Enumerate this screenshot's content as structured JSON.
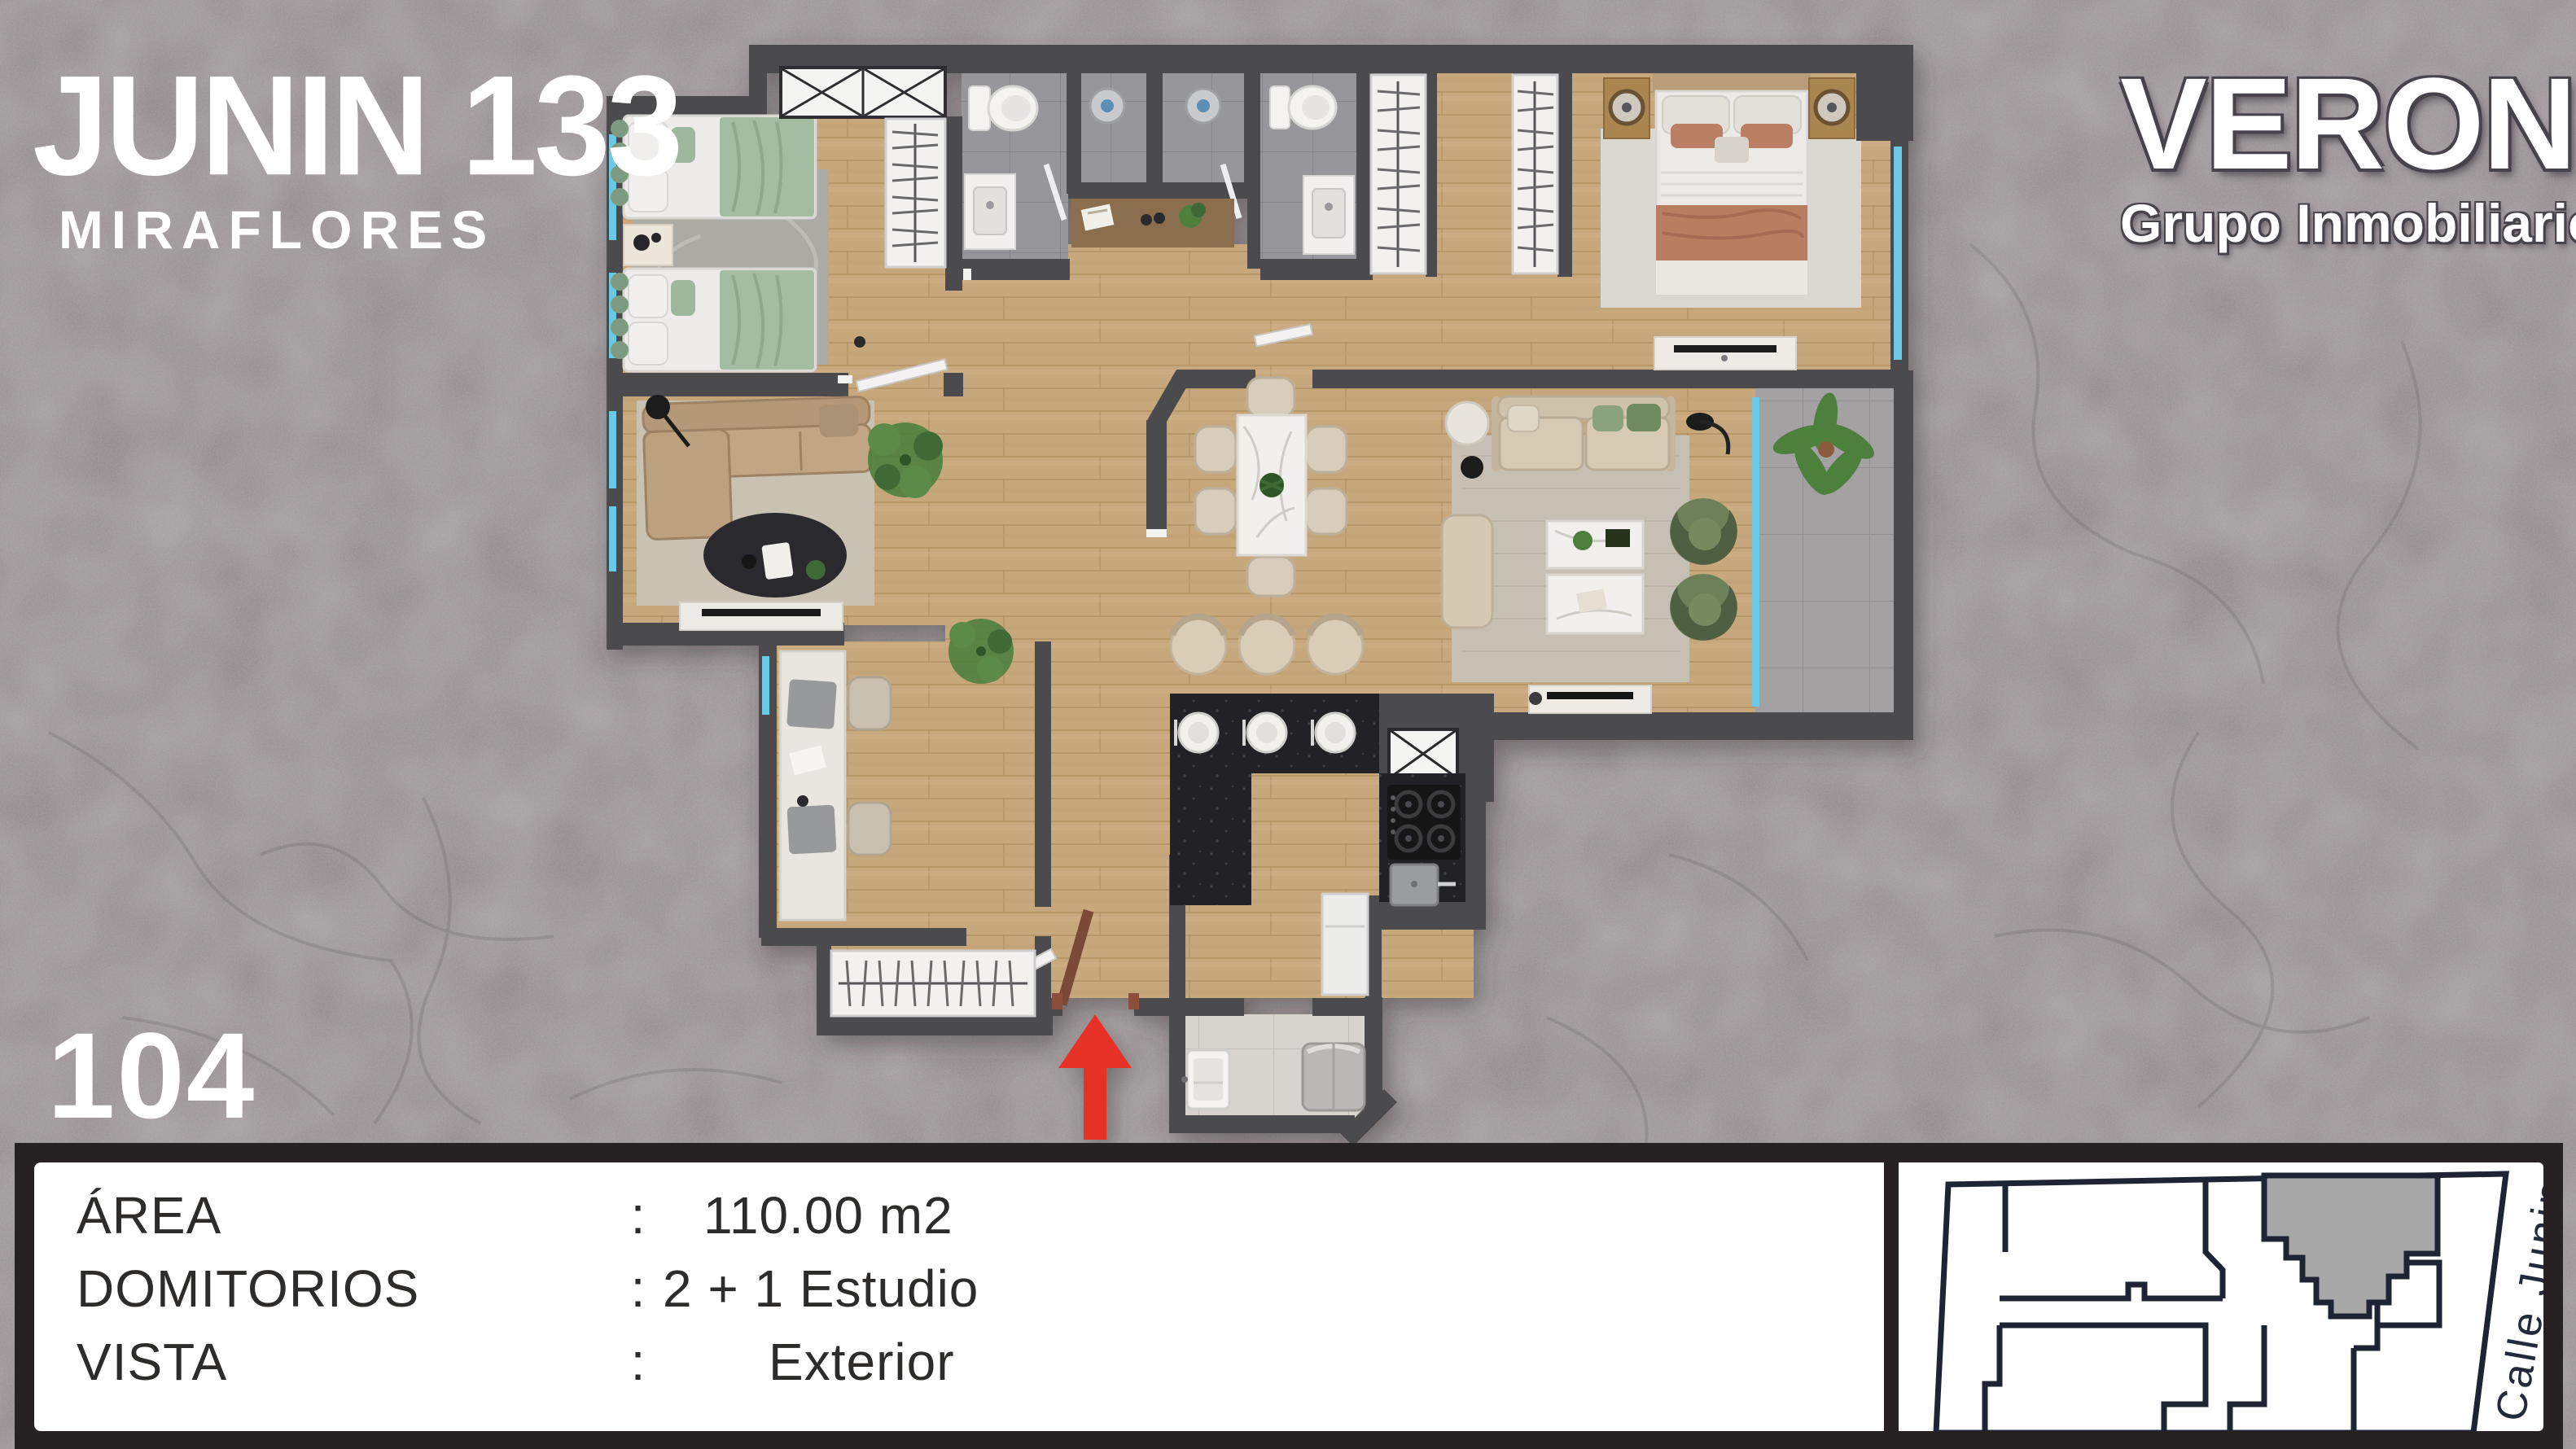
{
  "branding": {
    "project_name": "JUNIN 133",
    "project_location": "MIRAFLORES",
    "company_name": "VERONÉS",
    "company_tagline": "Grupo Inmobiliario"
  },
  "unit": {
    "number": "104"
  },
  "details": {
    "rows": [
      {
        "label": "ÁREA",
        "separator": ":",
        "value": "110.00 m2"
      },
      {
        "label": "DOMITORIOS",
        "separator": ":",
        "value": "2 + 1 Estudio"
      },
      {
        "label": "VISTA",
        "separator": ":",
        "value": "Exterior"
      }
    ]
  },
  "keyplan": {
    "street_label": "Calle Junin",
    "unit_highlight_color": "#a8a8a8",
    "outline_color": "#1e2433"
  },
  "floor_plan": {
    "wall_color": "#4b4b4e",
    "wood_color": "#c7a87d",
    "bath_tile_color": "#97979b",
    "terrace_tile_color": "#a3a1a2",
    "laundry_tile_color": "#d7d4cf",
    "glass_color": "#6cc9e4",
    "counter_color": "#232428",
    "entrance_arrow_color": "#e63327"
  }
}
